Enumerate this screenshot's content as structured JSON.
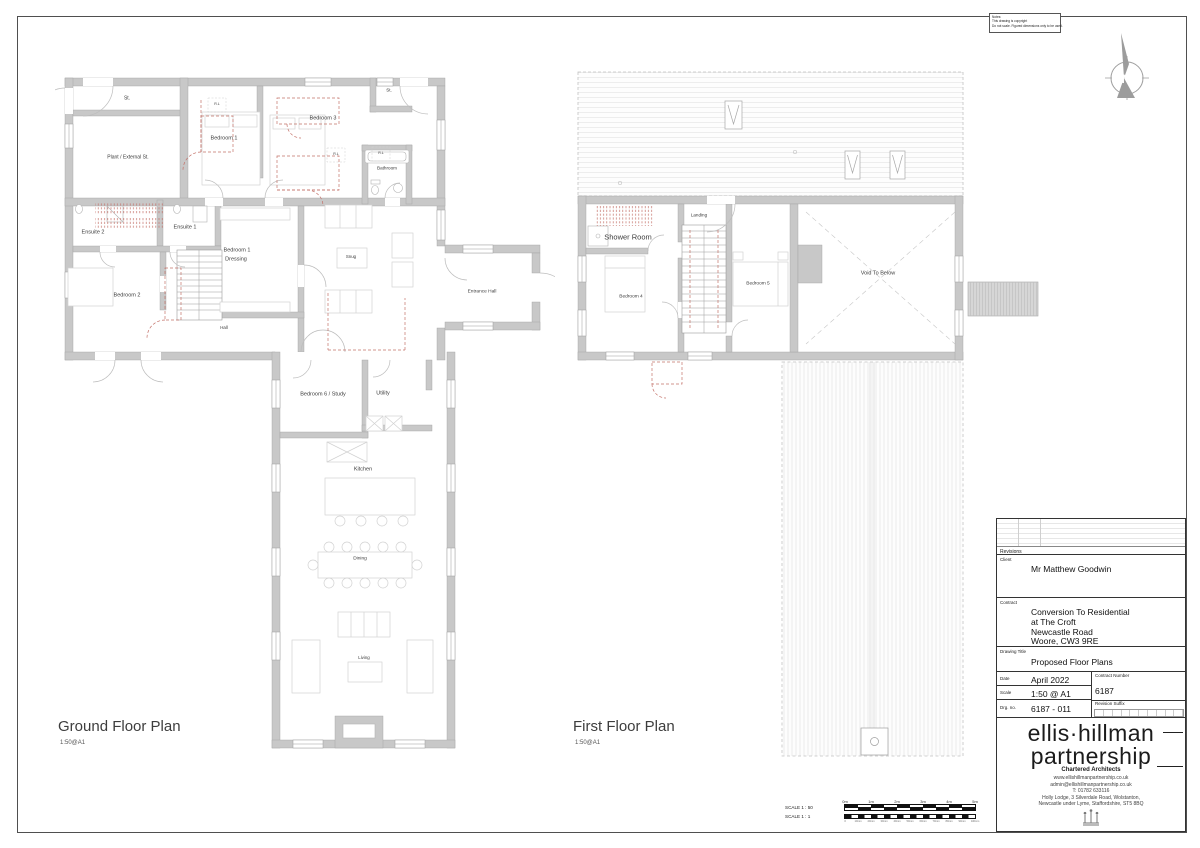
{
  "sheet": {
    "notes": [
      "Notes:",
      "This drawing is copyright",
      "Do not scale. Figured dimensions only to be used."
    ],
    "north_label": "N"
  },
  "ground_floor": {
    "title": "Ground Floor Plan",
    "scale_note": "1:50@A1",
    "rooms": {
      "st_top": "St.",
      "plant": "Plant / External St.",
      "bedroom1": "Bedroom 1",
      "bedroom3": "Bedroom 3",
      "bathroom": "Bathroom",
      "st_right": "St.",
      "rl": "R.L",
      "ensuite2": "Ensuite 2",
      "ensuite1": "Ensuite 1",
      "dressing_line1": "Bedroom 1",
      "dressing_line2": "Dressing",
      "bedroom2": "Bedroom 2",
      "hall": "Hall",
      "snug": "Snug",
      "entrance_hall": "Entrance Hall",
      "bedroom6": "Bedroom 6 / Study",
      "utility": "Utility",
      "kitchen": "Kitchen",
      "dining": "Dining",
      "living": "Living"
    }
  },
  "first_floor": {
    "title": "First Floor Plan",
    "scale_note": "1:50@A1",
    "rooms": {
      "shower_room": "Shower Room",
      "landing": "Landing",
      "bedroom4": "Bedroom 4",
      "bedroom5": "Bedroom 5",
      "void": "Void To Below"
    }
  },
  "scale_bar": {
    "row1_label": "SCALE 1 : 50",
    "row2_label": "SCALE 1 : 1",
    "metric_labels": [
      "0m",
      "1m",
      "2m",
      "3m",
      "4m",
      "5m"
    ],
    "mm_labels": [
      "0",
      "10mm",
      "20mm",
      "30mm",
      "40mm",
      "50mm",
      "60mm",
      "70mm",
      "80mm",
      "90mm",
      "100mm"
    ]
  },
  "title_block": {
    "revisions_label": "Revisions",
    "client_label": "Client",
    "client": "Mr Matthew Goodwin",
    "contract_label": "Contract",
    "contract_lines": [
      "Conversion To Residential",
      "at The Croft",
      "Newcastle Road",
      "Woore, CW3 9RE"
    ],
    "drawing_title_label": "Drawing Title",
    "drawing_title": "Proposed Floor Plans",
    "date_label": "Date",
    "date": "April 2022",
    "contract_number_label": "Contract Number",
    "contract_number": "6187",
    "scale_label": "Scale",
    "scale": "1:50 @ A1",
    "drg_no_label": "Drg. no.",
    "drg_no": "6187 - 011",
    "revision_suffix_label": "Revision Suffix",
    "firm_name_line1": "ellis·hillman",
    "firm_name_line2": "partnership",
    "firm_tagline": "Chartered Architects",
    "website": "www.ellishillmanpartnership.co.uk",
    "email": "admin@ellishillmanpartnership.co.uk",
    "phone": "T: 01782 633116",
    "address_line1": "Holly Lodge, 3 Silverdale Road, Wolstanton,",
    "address_line2": "Newcastle under Lyme, Staffordshire, ST5 8BQ"
  },
  "colors": {
    "wall_fill": "#c8c8c8",
    "wall_edge": "#a0a0a0",
    "demolition_red": "#c4726a",
    "furniture_line": "#d2d2d2"
  }
}
